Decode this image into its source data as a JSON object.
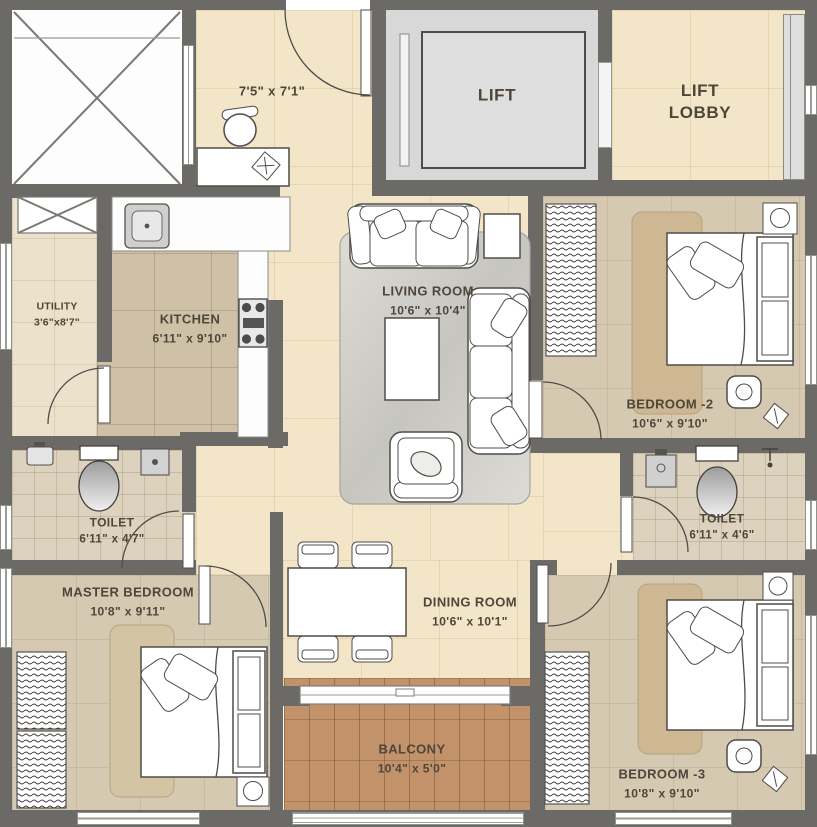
{
  "plan": {
    "rooms": {
      "foyer": {
        "dims": "7'5\" x 7'1\""
      },
      "lift": {
        "name": "LIFT"
      },
      "lift_lobby": {
        "name": "LIFT LOBBY"
      },
      "utility": {
        "name": "UTILITY",
        "dims": "3'6\"x8'7\""
      },
      "kitchen": {
        "name": "KITCHEN",
        "dims": "6'11\" x 9'10\""
      },
      "living": {
        "name": "LIVING ROOM",
        "dims": "10'6\" x 10'4\""
      },
      "bedroom2": {
        "name": "BEDROOM -2",
        "dims": "10'6\" x 9'10\""
      },
      "toilet1": {
        "name": "TOILET",
        "dims": "6'11\" x 4'7\""
      },
      "toilet2": {
        "name": "TOILET",
        "dims": "6'11\" x 4'6\""
      },
      "master": {
        "name": "MASTER BEDROOM",
        "dims": "10'8\" x 9'11\""
      },
      "dining": {
        "name": "DINING ROOM",
        "dims": "10'6\" x 10'1\""
      },
      "balcony": {
        "name": "BALCONY",
        "dims": "10'4\" x 5'0\""
      },
      "bedroom3": {
        "name": "BEDROOM -3",
        "dims": "10'8\" x 9'10\""
      }
    },
    "colors": {
      "wall": "#6b6a67",
      "tile_beige": "#f3e5c8",
      "carpet_tan": "#d6c9b2",
      "rug_tan": "#cdb893",
      "toilet_tile": "#dcd2bd",
      "balcony_wood": "#c2936b",
      "kitchen_floor": "#cfc1a7",
      "utility_floor": "#ece2cb",
      "lift_floor": "#d8d8d8",
      "furniture_line": "#4f4d49",
      "label_text": "#4e463b"
    }
  }
}
